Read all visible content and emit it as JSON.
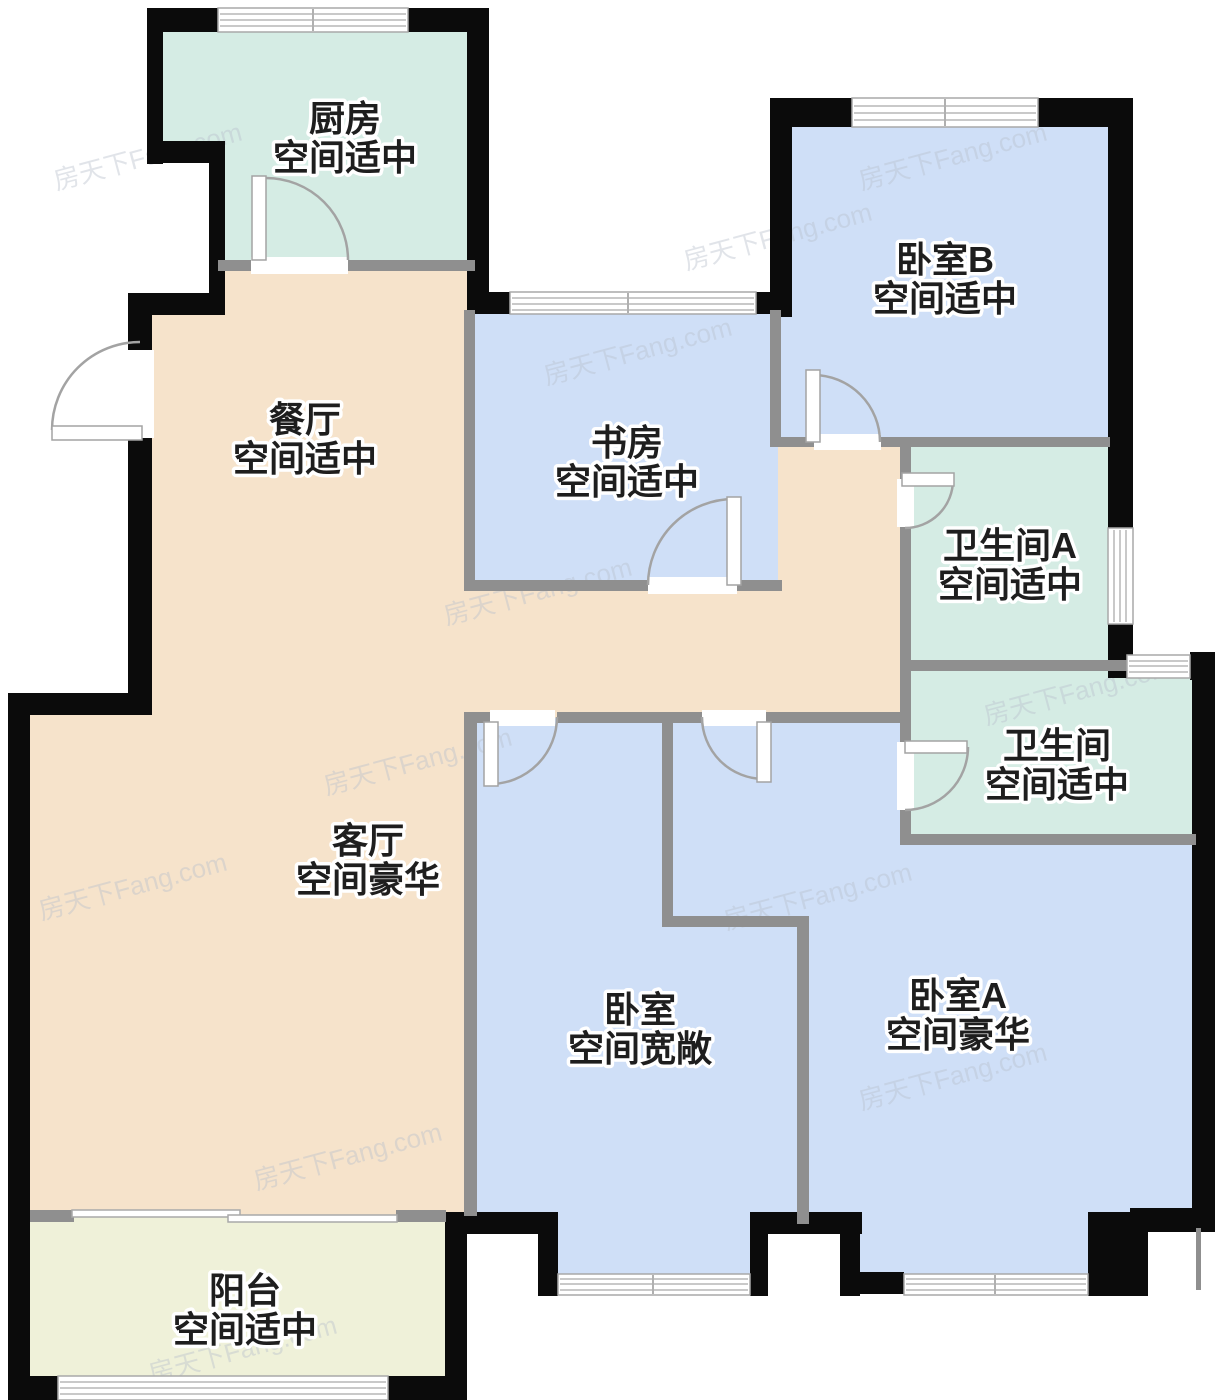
{
  "watermark": "房天下Fang.com",
  "colors": {
    "wall_exterior": "#0b0b0b",
    "wall_interior": "#8f8f8f",
    "room_teal": "#d5ece4",
    "room_blue": "#cfdff7",
    "room_beige": "#f6e3cb",
    "room_balcony": "#eff1d9",
    "label_text": "#1e1e1e"
  },
  "rooms": {
    "kitchen": {
      "name": "厨房",
      "size_desc": "空间适中"
    },
    "dining": {
      "name": "餐厅",
      "size_desc": "空间适中"
    },
    "study": {
      "name": "书房",
      "size_desc": "空间适中"
    },
    "bedroom_b": {
      "name": "卧室B",
      "size_desc": "空间适中"
    },
    "bathroom_a": {
      "name": "卫生间A",
      "size_desc": "空间适中"
    },
    "bathroom": {
      "name": "卫生间",
      "size_desc": "空间适中"
    },
    "living": {
      "name": "客厅",
      "size_desc": "空间豪华"
    },
    "bedroom": {
      "name": "卧室",
      "size_desc": "空间宽敞"
    },
    "bedroom_a": {
      "name": "卧室A",
      "size_desc": "空间豪华"
    },
    "balcony": {
      "name": "阳台",
      "size_desc": "空间适中"
    }
  }
}
